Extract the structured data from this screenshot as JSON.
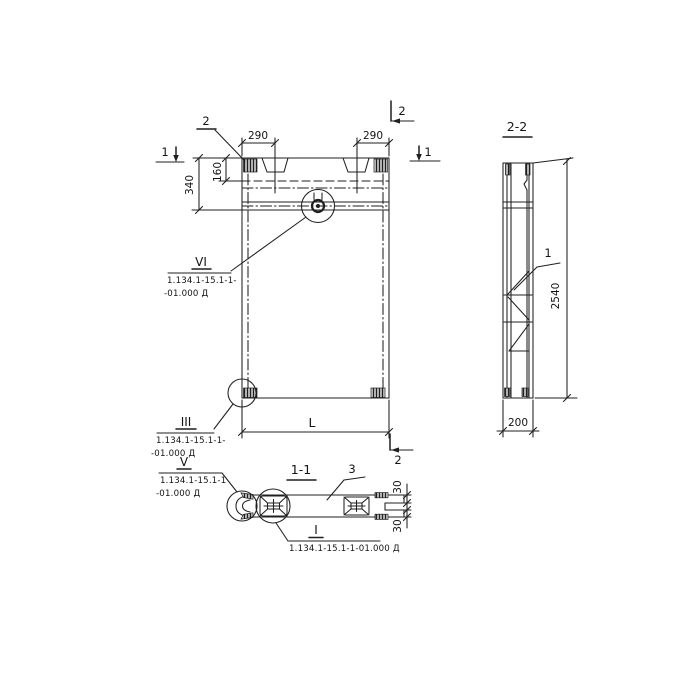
{
  "page": {
    "paper_color": "#ffffff",
    "ink_color": "#1f1f1f"
  },
  "elevation": {
    "markers": {
      "s1_left": "1",
      "s1_right": "1",
      "s2_leader": "2",
      "s2_top_right": "2",
      "s2_bottom_right": "2"
    },
    "dims": {
      "w_left": "290",
      "w_right": "290",
      "h_overall": "340",
      "h_inner": "160",
      "length": "L"
    },
    "callout_vi": {
      "num": "VI",
      "ref1": "1.134.1-15.1-1-",
      "ref2": "-01.000 Д"
    },
    "callout_iii": {
      "num": "III",
      "ref1": "1.134.1-15.1-1-",
      "ref2": "-01.000 Д"
    }
  },
  "section22": {
    "title": "2-2",
    "part_label": "1",
    "dims": {
      "height": "2540",
      "width": "200"
    }
  },
  "section11": {
    "title": "1-1",
    "part_label": "3",
    "dims": {
      "t_top": "30",
      "t_bottom": "30"
    },
    "callout_v": {
      "num": "V",
      "ref1": "1.134.1-15.1-1",
      "ref2": "-01.000 Д"
    },
    "callout_i": {
      "num": "I",
      "ref": "1.134.1-15.1-1-01.000 Д"
    }
  }
}
